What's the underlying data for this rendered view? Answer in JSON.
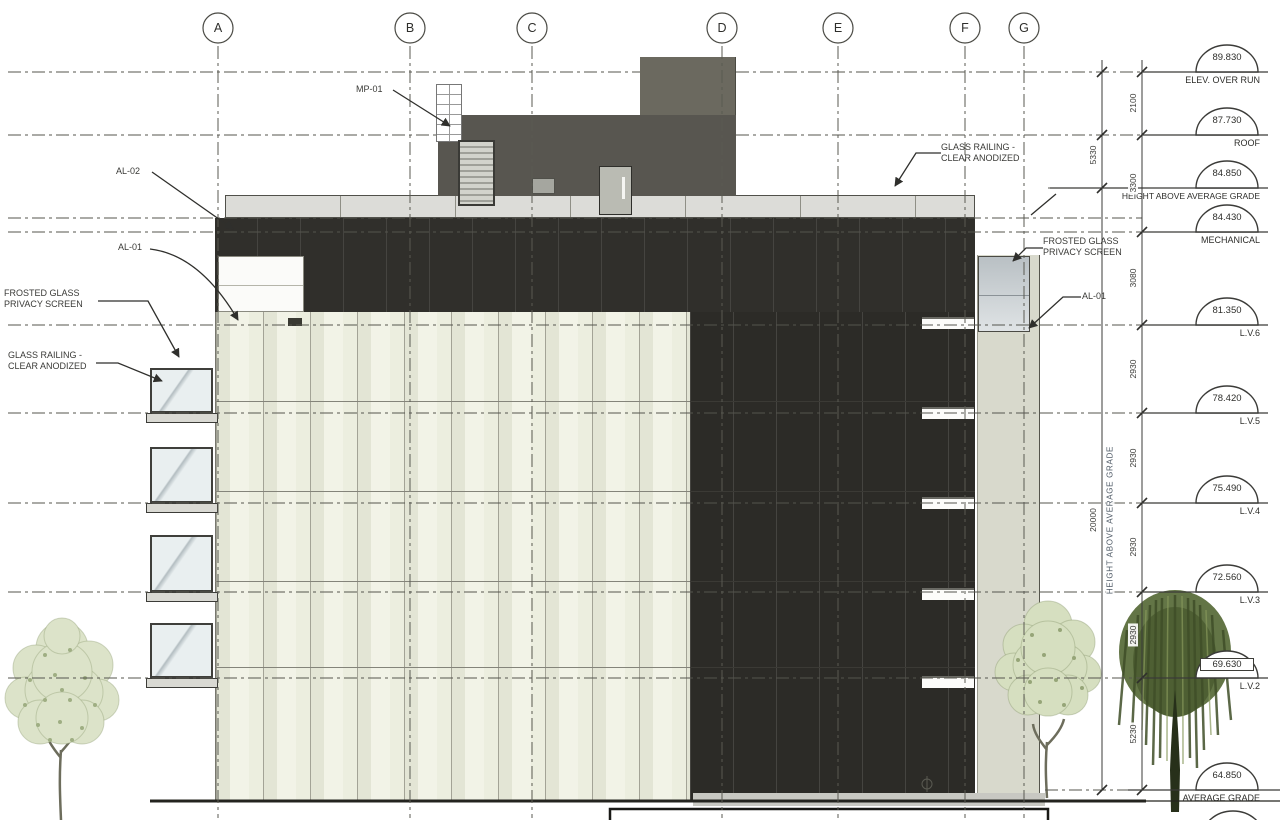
{
  "drawing": {
    "grid_labels": [
      "A",
      "B",
      "C",
      "D",
      "E",
      "F",
      "G"
    ],
    "markers": [
      {
        "value": "89.830",
        "label": "ELEV. OVER RUN"
      },
      {
        "value": "87.730",
        "label": "ROOF"
      },
      {
        "value": "84.850",
        "label": "HEIGHT ABOVE AVERAGE GRADE"
      },
      {
        "value": "84.430",
        "label": "MECHANICAL"
      },
      {
        "value": "81.350",
        "label": "L.V.6"
      },
      {
        "value": "78.420",
        "label": "L.V.5"
      },
      {
        "value": "75.490",
        "label": "L.V.4"
      },
      {
        "value": "72.560",
        "label": "L.V.3"
      },
      {
        "value": "69.630",
        "label": "L.V.2"
      },
      {
        "value": "64.850",
        "label": "AVERAGE GRADE"
      }
    ],
    "dimensions": {
      "outer": [
        "2100",
        "3300",
        "3080",
        "2930",
        "2930",
        "2930",
        "2930",
        "5230"
      ],
      "inner": [
        "5330",
        "20000"
      ],
      "vertical_axis_label": "HEIGHT ABOVE AVERAGE GRADE"
    },
    "callouts": {
      "mp01": "MP-01",
      "al02": "AL-02",
      "al01_left": "AL-01",
      "al01_right": "AL-01",
      "frosted_line1": "FROSTED GLASS",
      "frosted_line2": "PRIVACY SCREEN",
      "railing_line1": "GLASS RAILING -",
      "railing_line2": "CLEAR ANODIZED"
    },
    "colors": {
      "facade_cream": "#f1f2e6",
      "facade_dark": "#2c2b27",
      "penthouse": "#585650",
      "parapet": "#dcdcd8",
      "balcony_glass": "#e9eff0",
      "privacy_screen": "#c3c9cd",
      "foliage_light": "#dce3c9",
      "foliage_dark": "#5d7040"
    }
  }
}
